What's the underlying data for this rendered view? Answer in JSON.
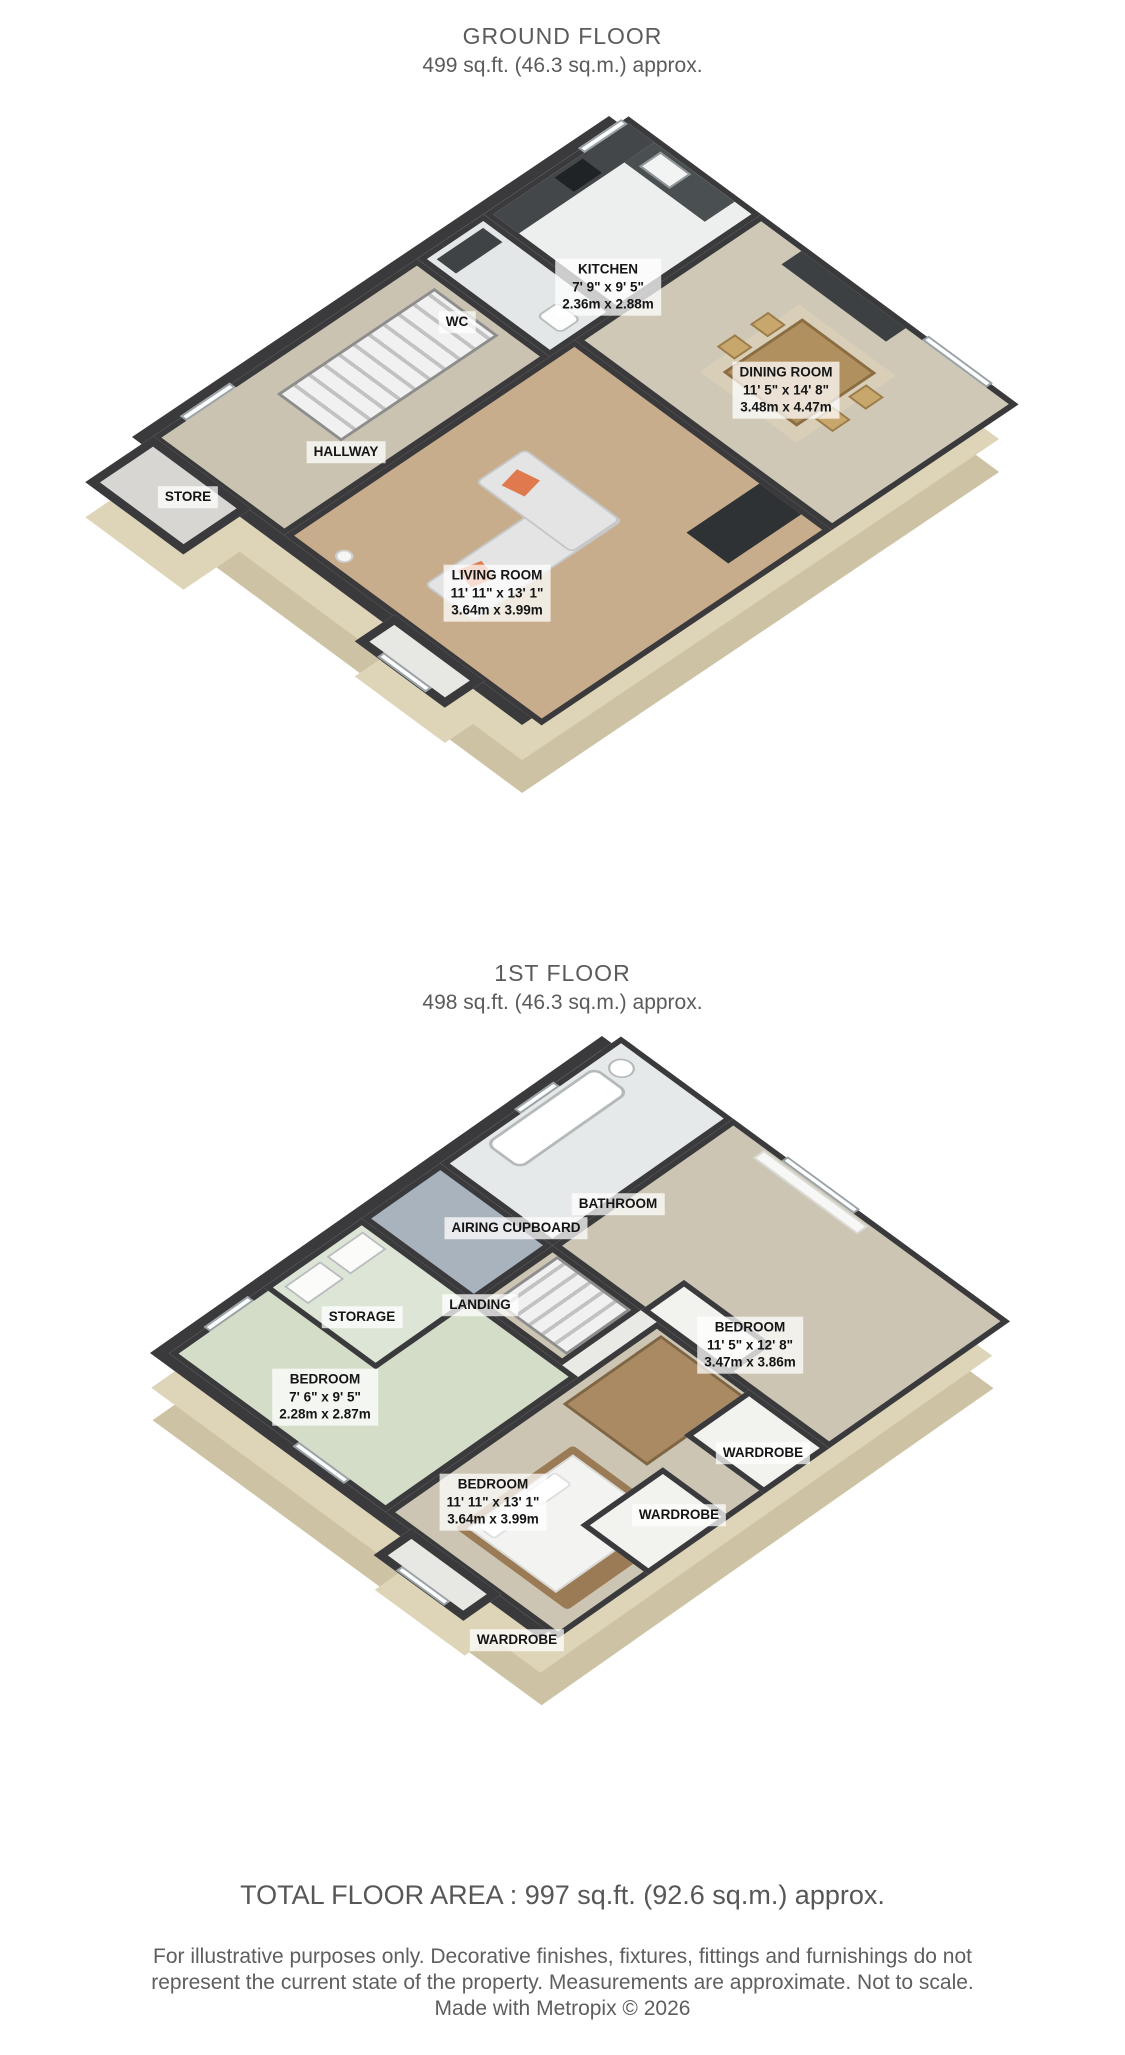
{
  "floors": [
    {
      "title": "GROUND FLOOR",
      "subtitle": "499 sq.ft. (46.3 sq.m.) approx.",
      "rooms": [
        {
          "name": "KITCHEN",
          "dims_imperial": "7' 9\" x 9' 5\"",
          "dims_metric": "2.36m x 2.88m"
        },
        {
          "name": "WC"
        },
        {
          "name": "DINING ROOM",
          "dims_imperial": "11' 5\" x 14' 8\"",
          "dims_metric": "3.48m x 4.47m"
        },
        {
          "name": "HALLWAY"
        },
        {
          "name": "STORE"
        },
        {
          "name": "LIVING ROOM",
          "dims_imperial": "11' 11\" x 13' 1\"",
          "dims_metric": "3.64m x 3.99m"
        }
      ]
    },
    {
      "title": "1ST FLOOR",
      "subtitle": "498 sq.ft. (46.3 sq.m.) approx.",
      "rooms": [
        {
          "name": "BATHROOM"
        },
        {
          "name": "AIRING CUPBOARD"
        },
        {
          "name": "STORAGE"
        },
        {
          "name": "LANDING"
        },
        {
          "name": "BEDROOM",
          "dims_imperial": "11' 5\" x 12' 8\"",
          "dims_metric": "3.47m x 3.86m"
        },
        {
          "name": "BEDROOM",
          "dims_imperial": "7' 6\" x 9' 5\"",
          "dims_metric": "2.28m x 2.87m"
        },
        {
          "name": "WARDROBE"
        },
        {
          "name": "BEDROOM",
          "dims_imperial": "11' 11\" x 13' 1\"",
          "dims_metric": "3.64m x 3.99m"
        },
        {
          "name": "WARDROBE"
        },
        {
          "name": "WARDROBE"
        }
      ]
    }
  ],
  "footer": {
    "total": "TOTAL FLOOR AREA : 997 sq.ft. (92.6 sq.m.) approx.",
    "disclaimer_line1": "For illustrative purposes only. Decorative finishes, fixtures, fittings and furnishings do not",
    "disclaimer_line2": "represent the current state of the property. Measurements are approximate. Not to scale.",
    "disclaimer_line3": "Made with Metropix © 2026"
  },
  "colors": {
    "wall": "#3a3a3c",
    "exterior_skirt": "#ded5b8",
    "carpet": "#cbc3b1",
    "wood_floor": "#c8ad8d",
    "accent_cushion": "#e07a4e",
    "heading_text": "#5b5b5b"
  }
}
